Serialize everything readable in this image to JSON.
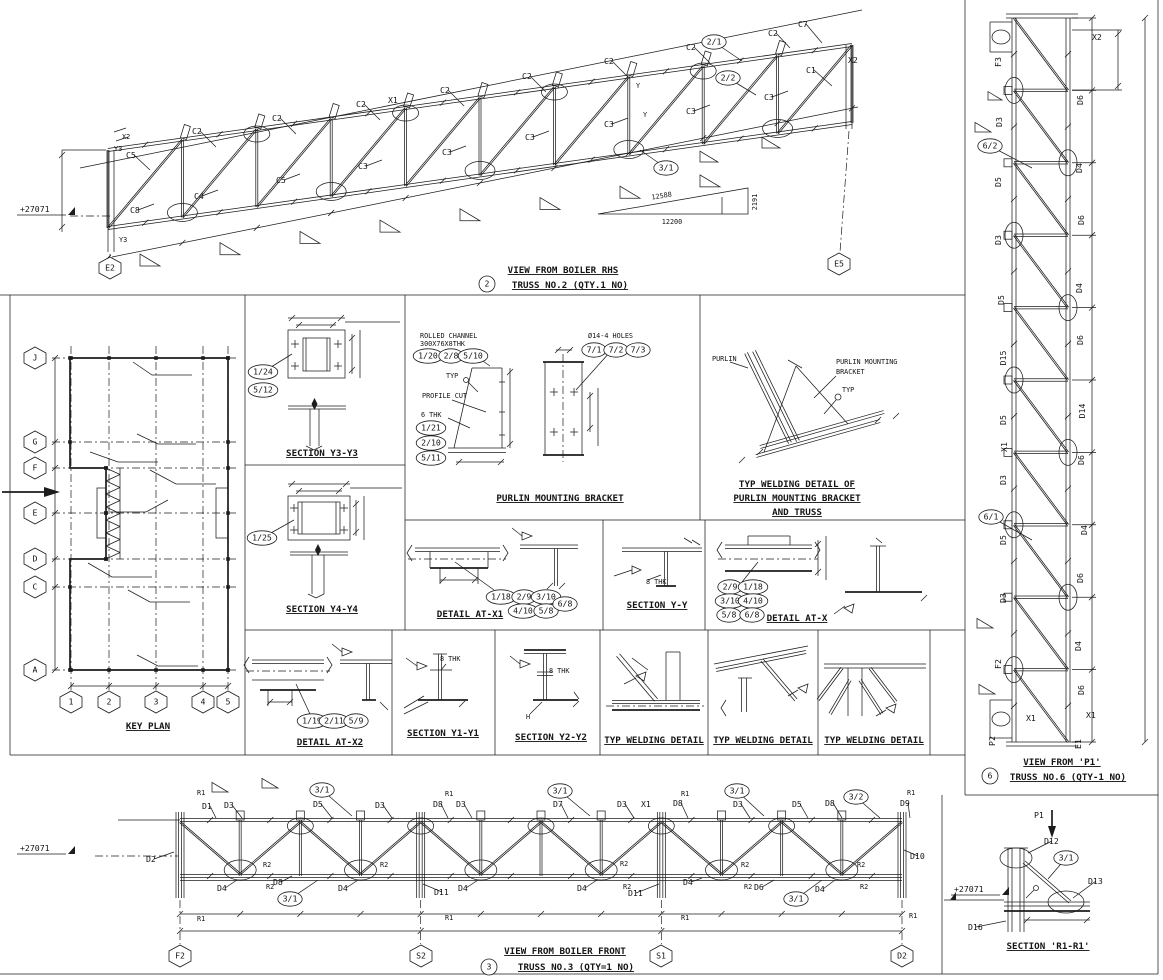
{
  "palette": {
    "ink": "#1c1c1c",
    "paper": "#ffffff"
  },
  "titles": {
    "truss2_view": "VIEW FROM BOILER RHS",
    "truss2_name": "TRUSS NO.2 (QTY.1 NO)",
    "truss6_view": "VIEW FROM 'P1'",
    "truss6_name": "TRUSS NO.6 (QTY-1 NO)",
    "truss3_view": "VIEW FROM BOILER FRONT",
    "truss3_name": "TRUSS NO.3 (QTY=1 NO)",
    "key_plan": "KEY PLAN",
    "section_y3": "SECTION Y3-Y3",
    "section_y4": "SECTION Y4-Y4",
    "purlin_bracket": "PURLIN MOUNTING BRACKET",
    "weld_pmb_1": "TYP WELDING DETAIL OF",
    "weld_pmb_2": "PURLIN MOUNTING BRACKET",
    "weld_pmb_3": "AND TRUSS",
    "detail_x1": "DETAIL AT-X1",
    "section_yy": "SECTION Y-Y",
    "detail_x": "DETAIL AT-X",
    "detail_x2": "DETAIL AT-X2",
    "section_y1": "SECTION Y1-Y1",
    "section_y2": "SECTION Y2-Y2",
    "weld_typ": "TYP WELDING DETAIL",
    "section_r1": "SECTION 'R1-R1'"
  },
  "grid": {
    "rows": [
      "J",
      "G",
      "F",
      "E",
      "D",
      "C",
      "A"
    ],
    "cols": [
      "1",
      "2",
      "3",
      "4",
      "5"
    ]
  },
  "slope": {
    "hyp": "12588",
    "base": "12200",
    "rise": "2191"
  },
  "level": "+27071",
  "annotations": [
    {
      "t": "C5",
      "x": 126,
      "y": 158,
      "l": [
        150,
        170
      ]
    },
    {
      "t": "C2",
      "x": 192,
      "y": 134,
      "l": [
        216,
        147
      ]
    },
    {
      "t": "C2",
      "x": 272,
      "y": 121,
      "l": [
        296,
        134
      ]
    },
    {
      "t": "C2",
      "x": 356,
      "y": 107,
      "l": [
        380,
        120
      ]
    },
    {
      "t": "X1",
      "x": 388,
      "y": 103
    },
    {
      "t": "C2",
      "x": 440,
      "y": 93,
      "l": [
        464,
        106
      ]
    },
    {
      "t": "C2",
      "x": 522,
      "y": 79,
      "l": [
        546,
        92
      ]
    },
    {
      "t": "C2",
      "x": 604,
      "y": 64,
      "l": [
        628,
        77
      ]
    },
    {
      "t": "C2",
      "x": 686,
      "y": 50,
      "l": [
        710,
        63
      ]
    },
    {
      "t": "C2",
      "x": 768,
      "y": 36,
      "l": [
        790,
        48
      ]
    },
    {
      "t": "C7",
      "x": 798,
      "y": 27,
      "l": [
        822,
        43
      ]
    },
    {
      "t": "C1",
      "x": 806,
      "y": 73,
      "l": [
        832,
        86
      ]
    },
    {
      "t": "X2",
      "x": 848,
      "y": 63
    },
    {
      "t": "C8",
      "x": 130,
      "y": 213,
      "l": [
        154,
        204
      ]
    },
    {
      "t": "C4",
      "x": 194,
      "y": 199,
      "l": [
        218,
        190
      ]
    },
    {
      "t": "C5",
      "x": 276,
      "y": 183,
      "l": [
        300,
        174
      ]
    },
    {
      "t": "C3",
      "x": 358,
      "y": 169,
      "l": [
        382,
        160
      ]
    },
    {
      "t": "C3",
      "x": 442,
      "y": 155,
      "l": [
        466,
        146
      ]
    },
    {
      "t": "C3",
      "x": 525,
      "y": 140,
      "l": [
        549,
        131
      ]
    },
    {
      "t": "C3",
      "x": 604,
      "y": 127,
      "l": [
        628,
        118
      ]
    },
    {
      "t": "C3",
      "x": 686,
      "y": 114,
      "l": [
        710,
        105
      ]
    },
    {
      "t": "C3",
      "x": 764,
      "y": 100,
      "l": [
        788,
        91
      ]
    },
    {
      "t": "2/1",
      "x": 714,
      "y": 42,
      "k": "b",
      "l": [
        742,
        61
      ]
    },
    {
      "t": "2/2",
      "x": 728,
      "y": 78,
      "k": "b",
      "l": [
        756,
        95
      ]
    },
    {
      "t": "3/1",
      "x": 666,
      "y": 168,
      "k": "b",
      "l": [
        640,
        150
      ]
    },
    {
      "t": "X2",
      "x": 122,
      "y": 139,
      "s": 1
    },
    {
      "t": "Y3",
      "x": 114,
      "y": 151,
      "s": 1
    },
    {
      "t": "Y3",
      "x": 119,
      "y": 242,
      "s": 1
    },
    {
      "t": "Y",
      "x": 636,
      "y": 88,
      "s": 1
    },
    {
      "t": "Y",
      "x": 643,
      "y": 117,
      "s": 1
    },
    {
      "t": "E2",
      "x": 110,
      "y": 268,
      "k": "h"
    },
    {
      "t": "E5",
      "x": 839,
      "y": 264,
      "k": "h"
    },
    {
      "t": "+27071",
      "x": 20,
      "y": 212,
      "k": "lvl"
    },
    {
      "t": "12588",
      "x": 662,
      "y": 198,
      "s": 1,
      "r": -9
    },
    {
      "t": "12200",
      "x": 672,
      "y": 224,
      "s": 1,
      "a": "m"
    },
    {
      "t": "2191",
      "x": 757,
      "y": 202,
      "s": 1,
      "r": -90
    },
    {
      "t": "2",
      "x": 487,
      "y": 284,
      "k": "c"
    },
    {
      "t": "F3",
      "x": 1001,
      "y": 62,
      "r": -90
    },
    {
      "t": "D3",
      "x": 1002,
      "y": 122,
      "r": -90
    },
    {
      "t": "D5",
      "x": 1001,
      "y": 182,
      "r": -90
    },
    {
      "t": "D3",
      "x": 1001,
      "y": 240,
      "r": -90
    },
    {
      "t": "D5",
      "x": 1004,
      "y": 300,
      "r": -90
    },
    {
      "t": "D15",
      "x": 1006,
      "y": 358,
      "r": -90
    },
    {
      "t": "D5",
      "x": 1006,
      "y": 420,
      "r": -90
    },
    {
      "t": "X1",
      "x": 1007,
      "y": 447,
      "r": -90
    },
    {
      "t": "D3",
      "x": 1006,
      "y": 480,
      "r": -90
    },
    {
      "t": "D5",
      "x": 1006,
      "y": 540,
      "r": -90
    },
    {
      "t": "D3",
      "x": 1006,
      "y": 598,
      "r": -90
    },
    {
      "t": "F2",
      "x": 1001,
      "y": 664,
      "r": -90
    },
    {
      "t": "6/2",
      "x": 990,
      "y": 146,
      "k": "b",
      "l": [
        1032,
        168
      ]
    },
    {
      "t": "6/1",
      "x": 991,
      "y": 517,
      "k": "b",
      "l": [
        1032,
        540
      ]
    },
    {
      "t": "X2",
      "x": 1092,
      "y": 40
    },
    {
      "t": "D6",
      "x": 1083,
      "y": 100,
      "r": -90
    },
    {
      "t": "D4",
      "x": 1082,
      "y": 168,
      "r": -90
    },
    {
      "t": "D6",
      "x": 1084,
      "y": 220,
      "r": -90
    },
    {
      "t": "D4",
      "x": 1082,
      "y": 288,
      "r": -90
    },
    {
      "t": "D6",
      "x": 1083,
      "y": 340,
      "r": -90
    },
    {
      "t": "D14",
      "x": 1085,
      "y": 411,
      "r": -90
    },
    {
      "t": "D6",
      "x": 1084,
      "y": 460,
      "r": -90
    },
    {
      "t": "D4",
      "x": 1087,
      "y": 530,
      "r": -90
    },
    {
      "t": "D6",
      "x": 1083,
      "y": 578,
      "r": -90
    },
    {
      "t": "D4",
      "x": 1081,
      "y": 646,
      "r": -90
    },
    {
      "t": "D6",
      "x": 1084,
      "y": 690,
      "r": -90
    },
    {
      "t": "E1",
      "x": 1081,
      "y": 744,
      "r": -90
    },
    {
      "t": "X1",
      "x": 1026,
      "y": 721
    },
    {
      "t": "X1",
      "x": 1086,
      "y": 718
    },
    {
      "t": "P2",
      "x": 995,
      "y": 741,
      "r": -90
    },
    {
      "t": "6",
      "x": 990,
      "y": 776,
      "k": "c"
    },
    {
      "t": "D1",
      "x": 202,
      "y": 809,
      "l": [
        216,
        818
      ]
    },
    {
      "t": "D3",
      "x": 224,
      "y": 808,
      "l": [
        242,
        818
      ]
    },
    {
      "t": "3/1",
      "x": 322,
      "y": 790,
      "k": "b",
      "l": [
        352,
        816
      ]
    },
    {
      "t": "D5",
      "x": 313,
      "y": 807,
      "l": [
        332,
        818
      ]
    },
    {
      "t": "D3",
      "x": 375,
      "y": 808,
      "l": [
        392,
        818
      ]
    },
    {
      "t": "D8",
      "x": 433,
      "y": 807,
      "l": [
        448,
        818
      ]
    },
    {
      "t": "D3",
      "x": 456,
      "y": 807,
      "l": [
        472,
        818
      ]
    },
    {
      "t": "D7",
      "x": 553,
      "y": 807,
      "l": [
        568,
        818
      ]
    },
    {
      "t": "3/1",
      "x": 560,
      "y": 791,
      "k": "b",
      "l": [
        590,
        816
      ]
    },
    {
      "t": "D3",
      "x": 617,
      "y": 807,
      "l": [
        634,
        818
      ]
    },
    {
      "t": "X1",
      "x": 641,
      "y": 807
    },
    {
      "t": "D8",
      "x": 673,
      "y": 806,
      "l": [
        688,
        818
      ]
    },
    {
      "t": "3/1",
      "x": 737,
      "y": 791,
      "k": "b",
      "l": [
        764,
        816
      ]
    },
    {
      "t": "D3",
      "x": 733,
      "y": 807,
      "l": [
        750,
        818
      ]
    },
    {
      "t": "D5",
      "x": 792,
      "y": 807,
      "l": [
        808,
        818
      ]
    },
    {
      "t": "D8",
      "x": 825,
      "y": 806,
      "l": [
        842,
        818
      ]
    },
    {
      "t": "3/2",
      "x": 856,
      "y": 797,
      "k": "b",
      "l": [
        880,
        818
      ]
    },
    {
      "t": "D9",
      "x": 900,
      "y": 806,
      "l": [
        910,
        818
      ]
    },
    {
      "t": "R1",
      "x": 197,
      "y": 795,
      "s": 1
    },
    {
      "t": "R1",
      "x": 445,
      "y": 796,
      "s": 1
    },
    {
      "t": "R1",
      "x": 681,
      "y": 796,
      "s": 1
    },
    {
      "t": "R1",
      "x": 907,
      "y": 795,
      "s": 1
    },
    {
      "t": "R1",
      "x": 197,
      "y": 921,
      "s": 1
    },
    {
      "t": "R1",
      "x": 445,
      "y": 920,
      "s": 1
    },
    {
      "t": "R1",
      "x": 681,
      "y": 920,
      "s": 1
    },
    {
      "t": "R1",
      "x": 909,
      "y": 918,
      "s": 1
    },
    {
      "t": "D2",
      "x": 146,
      "y": 862,
      "l": [
        174,
        852
      ]
    },
    {
      "t": "D10",
      "x": 910,
      "y": 859,
      "l": [
        904,
        850
      ]
    },
    {
      "t": "D4",
      "x": 217,
      "y": 891,
      "l": [
        237,
        880
      ]
    },
    {
      "t": "D8",
      "x": 273,
      "y": 885,
      "l": [
        292,
        876
      ]
    },
    {
      "t": "3/1",
      "x": 290,
      "y": 899,
      "k": "b",
      "l": [
        318,
        880
      ]
    },
    {
      "t": "D4",
      "x": 338,
      "y": 891,
      "l": [
        358,
        880
      ]
    },
    {
      "t": "D11",
      "x": 434,
      "y": 895,
      "l": [
        423,
        884
      ]
    },
    {
      "t": "D4",
      "x": 458,
      "y": 891,
      "l": [
        478,
        880
      ]
    },
    {
      "t": "D4",
      "x": 577,
      "y": 891,
      "l": [
        597,
        880
      ]
    },
    {
      "t": "D11",
      "x": 628,
      "y": 896,
      "l": [
        659,
        884
      ]
    },
    {
      "t": "D4",
      "x": 683,
      "y": 885,
      "l": [
        702,
        878
      ]
    },
    {
      "t": "D6",
      "x": 754,
      "y": 890,
      "l": [
        774,
        880
      ]
    },
    {
      "t": "3/1",
      "x": 796,
      "y": 899,
      "k": "b",
      "l": [
        822,
        880
      ]
    },
    {
      "t": "D4",
      "x": 815,
      "y": 892,
      "l": [
        835,
        880
      ]
    },
    {
      "t": "R2",
      "x": 263,
      "y": 867,
      "s": 1
    },
    {
      "t": "R2",
      "x": 380,
      "y": 867,
      "s": 1
    },
    {
      "t": "R2",
      "x": 620,
      "y": 866,
      "s": 1
    },
    {
      "t": "R2",
      "x": 741,
      "y": 867,
      "s": 1
    },
    {
      "t": "R2",
      "x": 857,
      "y": 867,
      "s": 1
    },
    {
      "t": "R2",
      "x": 266,
      "y": 889,
      "s": 1
    },
    {
      "t": "R2",
      "x": 623,
      "y": 889,
      "s": 1
    },
    {
      "t": "R2",
      "x": 744,
      "y": 889,
      "s": 1
    },
    {
      "t": "R2",
      "x": 860,
      "y": 889,
      "s": 1
    },
    {
      "t": "+27071",
      "x": 20,
      "y": 851,
      "k": "lvl"
    },
    {
      "t": "F2",
      "x": 180,
      "y": 956,
      "k": "h"
    },
    {
      "t": "S2",
      "x": 421,
      "y": 956,
      "k": "h"
    },
    {
      "t": "S1",
      "x": 661,
      "y": 956,
      "k": "h"
    },
    {
      "t": "D2",
      "x": 902,
      "y": 956,
      "k": "h"
    },
    {
      "t": "3",
      "x": 489,
      "y": 967,
      "k": "c"
    },
    {
      "t": "J",
      "x": 35,
      "y": 358,
      "k": "h"
    },
    {
      "t": "G",
      "x": 35,
      "y": 442,
      "k": "h"
    },
    {
      "t": "F",
      "x": 35,
      "y": 468,
      "k": "h"
    },
    {
      "t": "E",
      "x": 35,
      "y": 513,
      "k": "h"
    },
    {
      "t": "D",
      "x": 35,
      "y": 559,
      "k": "h"
    },
    {
      "t": "C",
      "x": 35,
      "y": 587,
      "k": "h"
    },
    {
      "t": "A",
      "x": 35,
      "y": 670,
      "k": "h"
    },
    {
      "t": "1",
      "x": 71,
      "y": 702,
      "k": "h"
    },
    {
      "t": "2",
      "x": 109,
      "y": 702,
      "k": "h"
    },
    {
      "t": "3",
      "x": 156,
      "y": 702,
      "k": "h"
    },
    {
      "t": "4",
      "x": 203,
      "y": 702,
      "k": "h"
    },
    {
      "t": "5",
      "x": 228,
      "y": 702,
      "k": "h"
    },
    {
      "t": "1/24",
      "x": 263,
      "y": 372,
      "k": "b",
      "l": [
        292,
        354
      ]
    },
    {
      "t": "5/12",
      "x": 263,
      "y": 390,
      "k": "b"
    },
    {
      "t": "1/25",
      "x": 262,
      "y": 538,
      "k": "b",
      "l": [
        294,
        520
      ]
    },
    {
      "t": "ROLLED CHANNEL",
      "x": 420,
      "y": 338,
      "s": 1
    },
    {
      "t": "300X76X8THK",
      "x": 420,
      "y": 346,
      "s": 1
    },
    {
      "t": "1/20",
      "x": 428,
      "y": 356,
      "k": "b"
    },
    {
      "t": "2/8",
      "x": 451,
      "y": 356,
      "k": "b"
    },
    {
      "t": "5/10",
      "x": 473,
      "y": 356,
      "k": "b"
    },
    {
      "t": "Ø14-4 HOLES",
      "x": 588,
      "y": 338,
      "s": 1
    },
    {
      "t": "7/1",
      "x": 594,
      "y": 350,
      "k": "b"
    },
    {
      "t": "7/2",
      "x": 616,
      "y": 350,
      "k": "b"
    },
    {
      "t": "7/3",
      "x": 638,
      "y": 350,
      "k": "b"
    },
    {
      "t": "TYP",
      "x": 446,
      "y": 378,
      "s": 1
    },
    {
      "t": "PROFILE CUT",
      "x": 422,
      "y": 398,
      "s": 1
    },
    {
      "t": "6 THK",
      "x": 421,
      "y": 417,
      "s": 1
    },
    {
      "t": "1/21",
      "x": 431,
      "y": 428,
      "k": "b"
    },
    {
      "t": "2/10",
      "x": 431,
      "y": 443,
      "k": "b"
    },
    {
      "t": "5/11",
      "x": 431,
      "y": 458,
      "k": "b"
    },
    {
      "t": "PURLIN",
      "x": 712,
      "y": 361,
      "s": 1
    },
    {
      "t": "PURLIN MOUNTING",
      "x": 836,
      "y": 364,
      "s": 1
    },
    {
      "t": "BRACKET",
      "x": 836,
      "y": 374,
      "s": 1
    },
    {
      "t": "TYP",
      "x": 842,
      "y": 392,
      "s": 1
    },
    {
      "t": "1/18",
      "x": 501,
      "y": 597,
      "k": "b"
    },
    {
      "t": "2/9",
      "x": 524,
      "y": 597,
      "k": "b"
    },
    {
      "t": "3/10",
      "x": 546,
      "y": 597,
      "k": "b"
    },
    {
      "t": "4/10",
      "x": 523,
      "y": 611,
      "k": "b"
    },
    {
      "t": "5/8",
      "x": 546,
      "y": 611,
      "k": "b"
    },
    {
      "t": "6/8",
      "x": 565,
      "y": 604,
      "k": "b"
    },
    {
      "t": "8 THK",
      "x": 646,
      "y": 584,
      "s": 1
    },
    {
      "t": "2/9",
      "x": 730,
      "y": 587,
      "k": "b"
    },
    {
      "t": "1/18",
      "x": 753,
      "y": 587,
      "k": "b"
    },
    {
      "t": "3/10",
      "x": 730,
      "y": 601,
      "k": "b"
    },
    {
      "t": "4/10",
      "x": 753,
      "y": 601,
      "k": "b"
    },
    {
      "t": "5/8",
      "x": 729,
      "y": 615,
      "k": "b"
    },
    {
      "t": "6/8",
      "x": 752,
      "y": 615,
      "k": "b"
    },
    {
      "t": "1/19",
      "x": 312,
      "y": 721,
      "k": "b"
    },
    {
      "t": "2/11",
      "x": 334,
      "y": 721,
      "k": "b"
    },
    {
      "t": "5/9",
      "x": 356,
      "y": 721,
      "k": "b"
    },
    {
      "t": "8 THK",
      "x": 440,
      "y": 661,
      "s": 1
    },
    {
      "t": "8 THK",
      "x": 549,
      "y": 673,
      "s": 1
    },
    {
      "t": "H",
      "x": 526,
      "y": 719,
      "s": 1
    },
    {
      "t": "P1",
      "x": 1034,
      "y": 818
    },
    {
      "t": "D12",
      "x": 1044,
      "y": 844,
      "l": [
        1028,
        853
      ]
    },
    {
      "t": "3/1",
      "x": 1066,
      "y": 858,
      "k": "b",
      "l": [
        1048,
        879
      ]
    },
    {
      "t": "D13",
      "x": 1088,
      "y": 884,
      "l": [
        1073,
        898
      ]
    },
    {
      "t": "+27071",
      "x": 954,
      "y": 892,
      "k": "lvl"
    },
    {
      "t": "D16",
      "x": 968,
      "y": 930,
      "l": [
        1006,
        921
      ]
    }
  ]
}
